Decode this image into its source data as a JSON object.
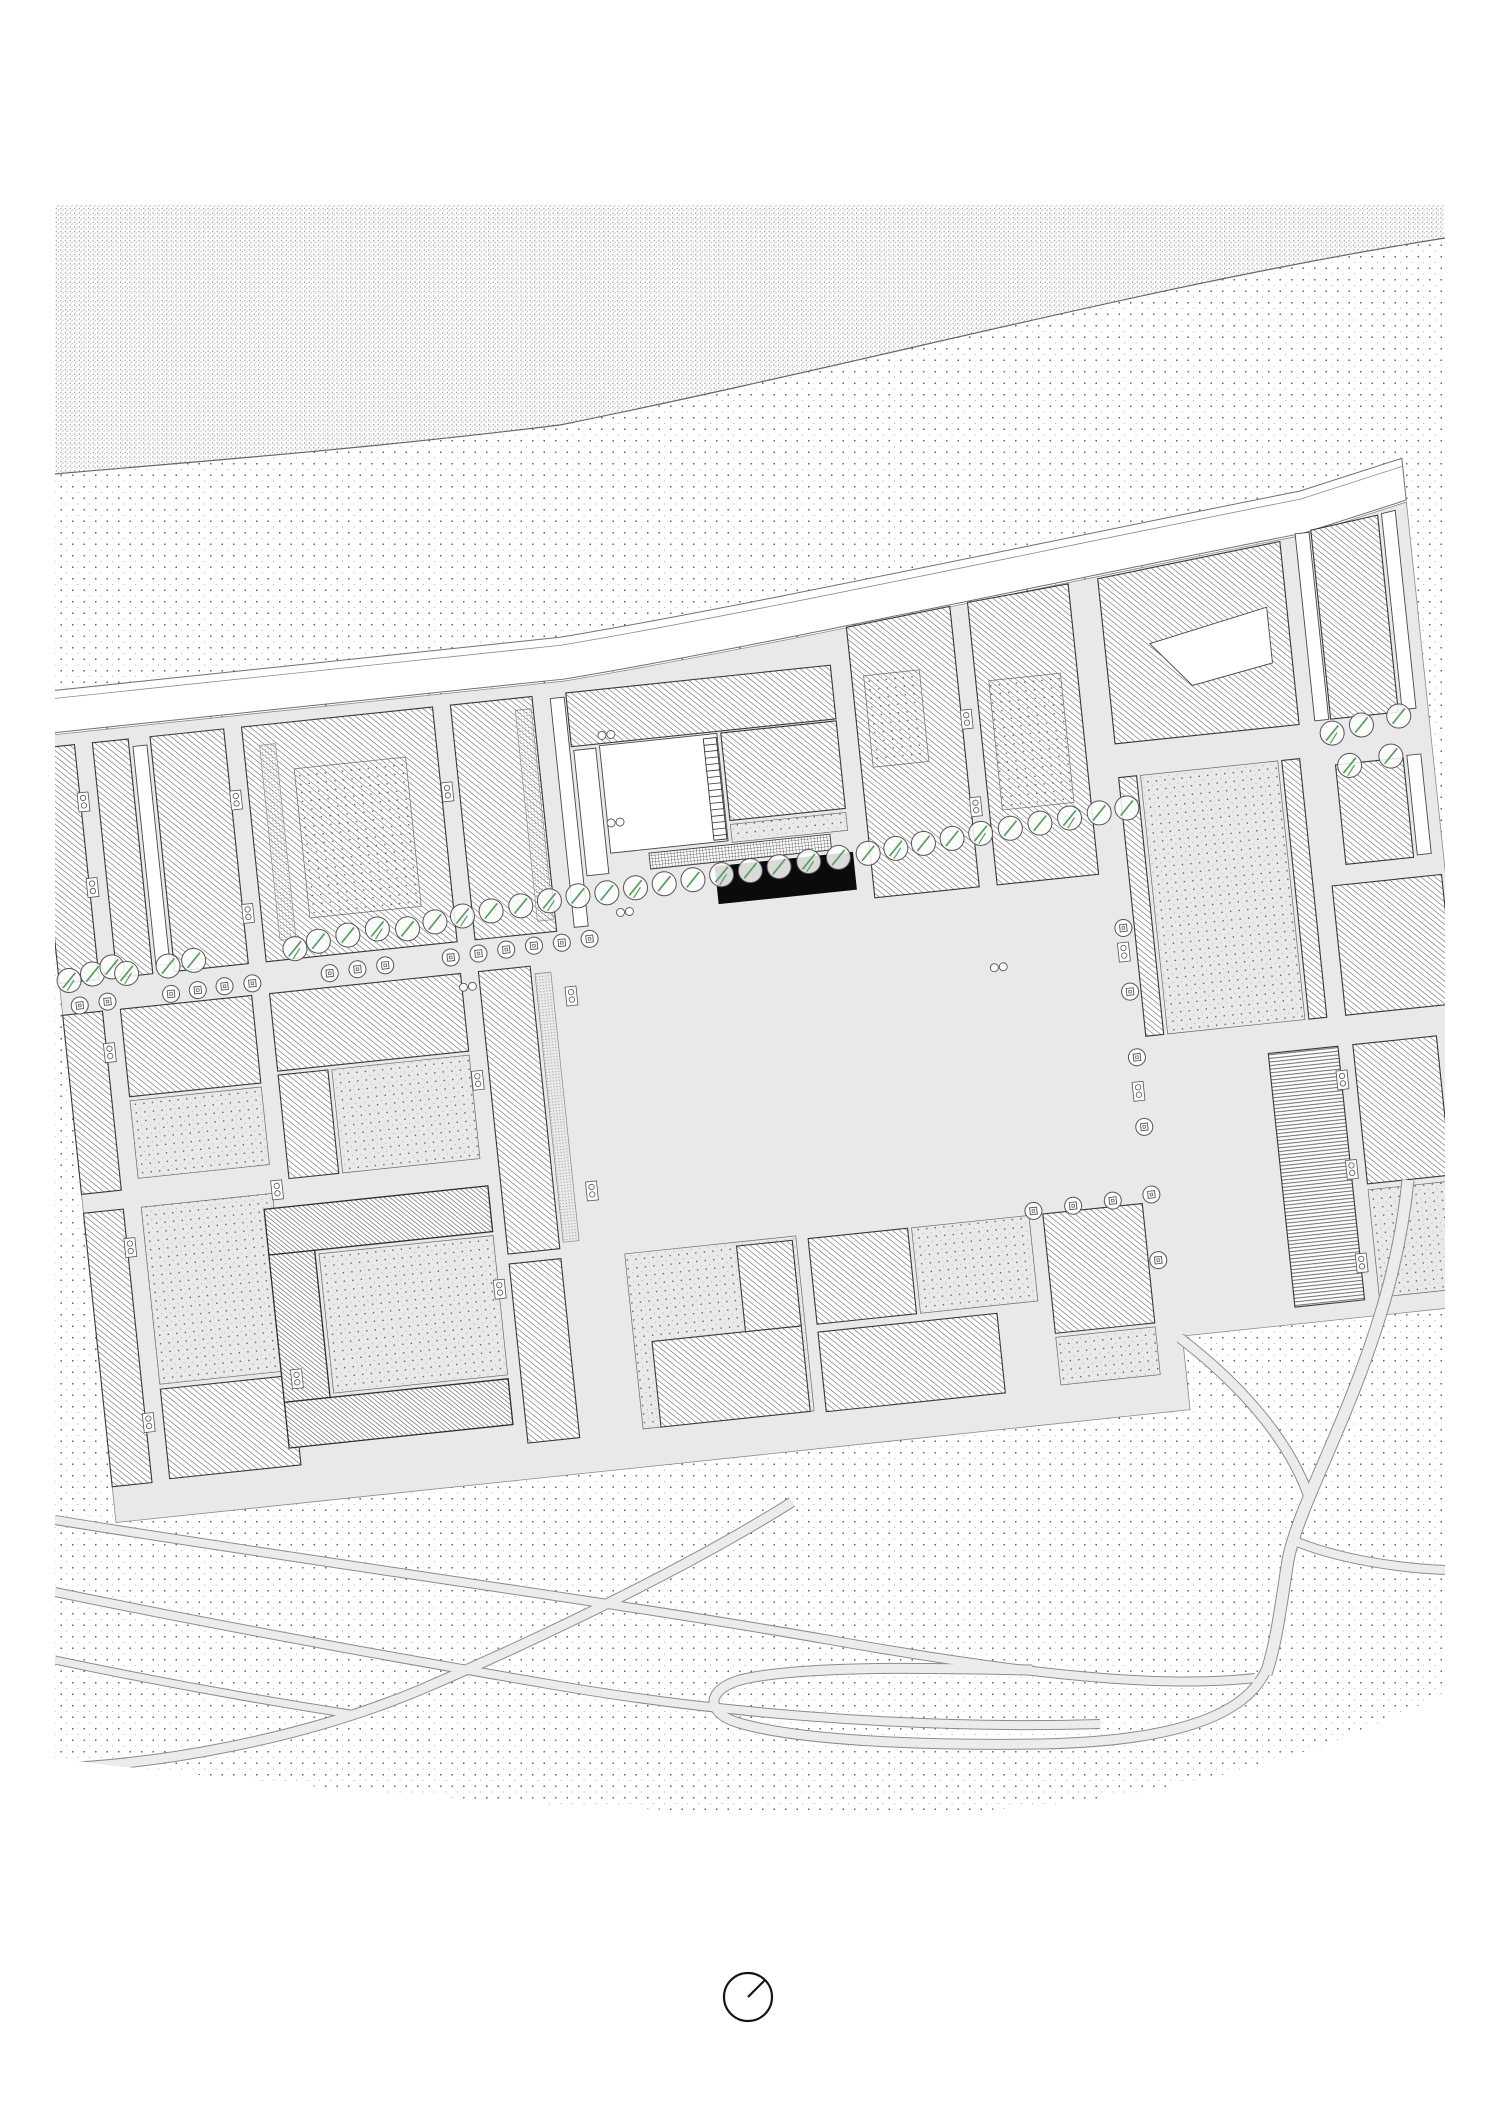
{
  "meta": {
    "width": 1500,
    "height": 2123,
    "background": "#ffffff",
    "kind": "architectural-site-plan"
  },
  "style": {
    "ink": "#3a3a3a",
    "building_outline": "#383838",
    "street_fill": "#e9e9e9",
    "street_edge": "#8c8c8c",
    "road_fill": "#ffffff",
    "road_edge": "#6f6f6f",
    "hatch_line": "#5c5c5c",
    "hatch_dense_line": "#474747",
    "grid_line": "#3c3c3c",
    "stipple_dark": "#636363",
    "stipple_light": "#aeaeae",
    "dense_a": "#8f8f8f",
    "dense_b": "#b5b5b5",
    "court_dark": "#4f4f4f",
    "court_light": "#9b9b9b",
    "fine_dot": "#7d7d7d",
    "tree_stroke": "#555555",
    "tree_green": "#55a05a",
    "black_building": "#0b0b0b",
    "north_stroke": "#151515"
  },
  "ground": {
    "dense_path": "M55,205 L1445,205 L1445,238 C1150,285 880,360 560,425 C340,452 140,466 55,474 Z",
    "sparse_path": "M55,474 C140,466 340,452 560,425 C880,360 1150,285 1445,238 L1445,1692 C1300,1770 1100,1815 850,1815 C600,1812 300,1790 55,1758 Z",
    "shore_path": "M55,474 C140,466 340,452 560,425 C880,360 1150,285 1445,238"
  },
  "city": {
    "rotation": {
      "angle": -6,
      "cx": 55,
      "cy": 990
    },
    "footprint_path": "M60,736 L594,736 C790,724 1100,690 1345,668 L1450,646 L1450,1452 L1140,1452 L1140,1526 L60,1526 Z",
    "road_band_path": "M60,692 L594,692 C790,680 1100,646 1345,624 L1450,602 L1450,644 L1345,666 C1100,688 790,722 594,734 L60,734 Z",
    "sidewalk_path": "M60,700 L594,700 C790,688 1100,654 1345,632 L1450,610",
    "plaza": {
      "r": [
        594,
        988,
        520,
        322
      ]
    },
    "stair": {
      "x": 726,
      "y": 808,
      "w": 13,
      "h": 102,
      "step": 6.5
    },
    "blocks": [
      {
        "n": "slab-west-a",
        "r": [
          60,
          748,
          40,
          236
        ],
        "f": "hatch"
      },
      {
        "n": "slab-col1-a",
        "r": [
          118,
          748,
          36,
          236
        ],
        "f": "hatch"
      },
      {
        "n": "strip-col1",
        "r": [
          158,
          756,
          14,
          220
        ],
        "f": "white"
      },
      {
        "n": "slab-col1-b",
        "r": [
          176,
          748,
          74,
          236
        ],
        "f": "hatch"
      },
      {
        "n": "block-col2-r1",
        "r": [
          268,
          748,
          192,
          236
        ],
        "f": "hatch"
      },
      {
        "n": "fine-col2-r1",
        "r": [
          284,
          768,
          16,
          196
        ],
        "f": "fine"
      },
      {
        "n": "court-col2-r1",
        "r": [
          316,
          795,
          112,
          150
        ],
        "f": "court"
      },
      {
        "n": "slab-col3-r1",
        "r": [
          478,
          748,
          82,
          236
        ],
        "f": "hatch"
      },
      {
        "n": "fine-col3-r1",
        "r": [
          542,
          760,
          16,
          212
        ],
        "f": "fine"
      },
      {
        "n": "strip-col3-r1",
        "r": [
          578,
          752,
          14,
          230
        ],
        "f": "white"
      },
      {
        "n": "site-north-bar",
        "r": [
          594,
          748,
          266,
          54
        ],
        "f": "hatch"
      },
      {
        "n": "site-west-slab",
        "r": [
          596,
          806,
          22,
          126
        ],
        "f": "white"
      },
      {
        "n": "site-courtyard",
        "r": [
          622,
          804,
          118,
          108
        ],
        "f": "white"
      },
      {
        "n": "site-east-arm",
        "r": [
          744,
          804,
          116,
          88
        ],
        "f": "hatch"
      },
      {
        "n": "site-east-yard",
        "r": [
          744,
          896,
          116,
          18
        ],
        "f": "court"
      },
      {
        "n": "site-grid-strip",
        "r": [
          660,
          916,
          182,
          16
        ],
        "f": "grid"
      },
      {
        "n": "highlighted-building",
        "r": [
          724,
          936,
          139,
          38
        ],
        "f": "black"
      },
      {
        "n": "block-r1-east1",
        "p": [
          [
            880,
            712
          ],
          [
            985,
            702
          ],
          [
            985,
            984
          ],
          [
            880,
            984
          ]
        ],
        "f": "hatch"
      },
      {
        "n": "court-r1-east1",
        "r": [
          892,
          762,
          56,
          92
        ],
        "f": "court"
      },
      {
        "n": "block-r1-east2",
        "p": [
          [
            1003,
            700
          ],
          [
            1105,
            692
          ],
          [
            1105,
            984
          ],
          [
            1003,
            984
          ]
        ],
        "f": "hatch"
      },
      {
        "n": "court-r1-east2",
        "r": [
          1016,
          780,
          72,
          130
        ],
        "f": "court"
      },
      {
        "n": "block-ne-large",
        "p": [
          [
            1135,
            690
          ],
          [
            1320,
            672
          ],
          [
            1320,
            856
          ],
          [
            1135,
            856
          ]
        ],
        "f": "hatch"
      },
      {
        "n": "notch-ne",
        "p": [
          [
            1180,
            760
          ],
          [
            1300,
            736
          ],
          [
            1300,
            792
          ],
          [
            1218,
            806
          ]
        ],
        "f": "white"
      },
      {
        "n": "strip-ne-a",
        "r": [
          1336,
          666,
          14,
          188
        ],
        "f": "white"
      },
      {
        "n": "slab-ne-a",
        "p": [
          [
            1352,
            664
          ],
          [
            1420,
            656
          ],
          [
            1420,
            854
          ],
          [
            1352,
            854
          ]
        ],
        "f": "hatch"
      },
      {
        "n": "strip-ne-b",
        "p": [
          [
            1424,
            655
          ],
          [
            1438,
            653
          ],
          [
            1438,
            852
          ],
          [
            1424,
            852
          ]
        ],
        "f": "white"
      },
      {
        "n": "slab-ne-b",
        "r": [
          1352,
          900,
          68,
          100
        ],
        "f": "hatch"
      },
      {
        "n": "strip-ne-c",
        "r": [
          1424,
          898,
          14,
          100
        ],
        "f": "white"
      },
      {
        "n": "slab-west-b",
        "r": [
          60,
          1016,
          40,
          180
        ],
        "f": "hatch"
      },
      {
        "n": "block-col1-r2",
        "r": [
          118,
          1016,
          132,
          88
        ],
        "f": "hatch"
      },
      {
        "n": "yard-col1-r2",
        "r": [
          118,
          1108,
          132,
          78
        ],
        "f": "court"
      },
      {
        "n": "bar-col2-r2",
        "r": [
          268,
          1016,
          192,
          78
        ],
        "f": "hatch"
      },
      {
        "n": "arm-col2-r2",
        "r": [
          268,
          1098,
          50,
          104
        ],
        "f": "hatch"
      },
      {
        "n": "court-col2-r2",
        "r": [
          322,
          1098,
          138,
          104
        ],
        "f": "court"
      },
      {
        "n": "slab-col3-r2",
        "r": [
          478,
          1016,
          52,
          284
        ],
        "f": "hatch"
      },
      {
        "n": "fine-col3-r2",
        "r": [
          534,
          1024,
          16,
          270
        ],
        "f": "fine"
      },
      {
        "n": "strip-e-plaza-a",
        "r": [
          1135,
          890,
          18,
          260
        ],
        "f": "hatch"
      },
      {
        "n": "yard-e-plaza",
        "r": [
          1157,
          890,
          138,
          260
        ],
        "f": "court"
      },
      {
        "n": "strip-e-plaza-b",
        "r": [
          1299,
          890,
          18,
          260
        ],
        "f": "hatch"
      },
      {
        "n": "block-ne-r2",
        "r": [
          1336,
          1020,
          110,
          130
        ],
        "f": "hatch"
      },
      {
        "n": "slab-west-c",
        "r": [
          60,
          1215,
          40,
          275
        ],
        "f": "hatch"
      },
      {
        "n": "yard-col1-r3",
        "r": [
          118,
          1215,
          132,
          178
        ],
        "f": "court"
      },
      {
        "n": "slab-col1-r3",
        "r": [
          118,
          1398,
          132,
          90
        ],
        "f": "hatch"
      },
      {
        "n": "cblock-top",
        "r": [
          240,
          1230,
          225,
          46
        ],
        "f": "hatchD"
      },
      {
        "n": "cblock-left",
        "r": [
          240,
          1276,
          46,
          148
        ],
        "f": "hatchD"
      },
      {
        "n": "cblock-bottom",
        "r": [
          240,
          1424,
          225,
          46
        ],
        "f": "hatchD"
      },
      {
        "n": "cblock-court",
        "r": [
          290,
          1280,
          175,
          140
        ],
        "f": "court"
      },
      {
        "n": "slab-col3-r3",
        "r": [
          478,
          1310,
          52,
          180
        ],
        "f": "hatch"
      },
      {
        "n": "yard-center-r3",
        "r": [
          594,
          1312,
          172,
          176
        ],
        "f": "court"
      },
      {
        "n": "slab-center-r3a",
        "r": [
          612,
          1402,
          150,
          86
        ],
        "f": "hatch"
      },
      {
        "n": "slab-center-r3b",
        "r": [
          706,
          1316,
          56,
          86
        ],
        "f": "hatch"
      },
      {
        "n": "slab-center-r3c",
        "r": [
          778,
          1316,
          100,
          86
        ],
        "f": "hatch"
      },
      {
        "n": "yard-center-r3b",
        "r": [
          882,
          1316,
          118,
          86
        ],
        "f": "court"
      },
      {
        "n": "slab-center-r3d",
        "r": [
          778,
          1410,
          180,
          80
        ],
        "f": "hatch"
      },
      {
        "n": "block-se-r3",
        "r": [
          1014,
          1316,
          100,
          120
        ],
        "f": "hatch"
      },
      {
        "n": "yard-se-r3",
        "r": [
          1014,
          1440,
          100,
          48
        ],
        "f": "court"
      },
      {
        "n": "slab-horiz-hatch",
        "r": [
          1255,
          1180,
          70,
          255
        ],
        "f": "hatchH"
      },
      {
        "n": "block-far-se",
        "r": [
          1340,
          1180,
          84,
          140
        ],
        "f": "hatch"
      },
      {
        "n": "yard-far-se",
        "r": [
          1340,
          1326,
          84,
          108
        ],
        "f": "court"
      }
    ],
    "markers": [
      [
        103,
        806
      ],
      [
        103,
        892
      ],
      [
        103,
        1058
      ],
      [
        103,
        1254
      ],
      [
        103,
        1430
      ],
      [
        255,
        820
      ],
      [
        255,
        934
      ],
      [
        255,
        1212
      ],
      [
        255,
        1402
      ],
      [
        466,
        834
      ],
      [
        466,
        1124
      ],
      [
        466,
        1334
      ],
      [
        568,
        1050
      ],
      [
        568,
        1246
      ],
      [
        990,
        816
      ],
      [
        990,
        904
      ],
      [
        1122,
        1064
      ],
      [
        1122,
        1204
      ],
      [
        1326,
        1214
      ],
      [
        1326,
        1304
      ],
      [
        1326,
        1398
      ]
    ],
    "pairs": [
      [
        630,
        794
      ],
      [
        630,
        882
      ],
      [
        630,
        972
      ],
      [
        996,
        1066
      ],
      [
        466,
        1030
      ]
    ],
    "trees": {
      "slash": [
        [
          70,
          982
        ],
        [
          94,
          978
        ],
        [
          114,
          973
        ],
        [
          128,
          981
        ],
        [
          170,
          978
        ],
        [
          196,
          975
        ],
        [
          298,
          974
        ],
        [
          322,
          969
        ],
        [
          352,
          966
        ],
        [
          382,
          963
        ],
        [
          412,
          966
        ],
        [
          440,
          962
        ],
        [
          468,
          959
        ],
        [
          497,
          957
        ],
        [
          527,
          955
        ],
        [
          556,
          953
        ],
        [
          585,
          951
        ],
        [
          614,
          951
        ],
        [
          643,
          949
        ],
        [
          672,
          948
        ],
        [
          701,
          947
        ],
        [
          730,
          945
        ],
        [
          759,
          944
        ],
        [
          788,
          943
        ],
        [
          818,
          941
        ],
        [
          848,
          940
        ],
        [
          878,
          939
        ],
        [
          906,
          937
        ],
        [
          934,
          935
        ],
        [
          963,
          933
        ],
        [
          992,
          931
        ],
        [
          1022,
          929
        ],
        [
          1052,
          927
        ],
        [
          1082,
          925
        ],
        [
          1112,
          923
        ],
        [
          1140,
          921
        ],
        [
          1352,
          868
        ],
        [
          1382,
          863
        ],
        [
          1420,
          858
        ],
        [
          1366,
          902
        ],
        [
          1408,
          897
        ]
      ],
      "square": [
        [
          78,
          1008
        ],
        [
          106,
          1007
        ],
        [
          170,
          1006
        ],
        [
          197,
          1005
        ],
        [
          224,
          1004
        ],
        [
          252,
          1004
        ],
        [
          330,
          1002
        ],
        [
          358,
          1001
        ],
        [
          386,
          1000
        ],
        [
          452,
          999
        ],
        [
          480,
          998
        ],
        [
          508,
          997
        ],
        [
          536,
          996
        ],
        [
          564,
          996
        ],
        [
          592,
          995
        ],
        [
          1124,
          1040
        ],
        [
          1124,
          1104
        ],
        [
          1124,
          1170
        ],
        [
          1124,
          1240
        ],
        [
          1124,
          1308
        ],
        [
          1124,
          1374
        ],
        [
          1005,
          1312
        ],
        [
          1045,
          1311
        ],
        [
          1085,
          1310
        ]
      ]
    }
  },
  "park": {
    "paths": [
      {
        "n": "park-path-1",
        "d": "M55,1520 C300,1560 600,1600 830,1640 C1000,1670 1150,1690 1255,1678",
        "w": 8
      },
      {
        "n": "park-path-2",
        "d": "M55,1592 C250,1632 420,1662 560,1686 C700,1710 900,1730 1100,1724",
        "w": 8
      },
      {
        "n": "park-path-3",
        "d": "M792,1502 C700,1560 560,1630 420,1690 C300,1740 160,1764 58,1768",
        "w": 9
      },
      {
        "n": "park-path-4",
        "d": "M55,1660 C150,1680 260,1700 350,1714",
        "w": 7
      },
      {
        "n": "park-connector",
        "d": "M1180,1338 C1240,1384 1290,1440 1310,1500",
        "w": 9
      },
      {
        "n": "road-east",
        "d": "M1408,1180 C1400,1260 1378,1330 1350,1400 C1322,1470 1296,1520 1288,1560 C1280,1612 1276,1644 1266,1674",
        "w": 11
      },
      {
        "n": "road-loop",
        "d": "M1266,1670 C1242,1724 1150,1742 1040,1744 C920,1746 792,1740 736,1722 C706,1712 706,1690 740,1680 C800,1665 930,1668 1032,1670",
        "w": 9
      },
      {
        "n": "road-branch",
        "d": "M1292,1540 C1340,1560 1400,1568 1445,1570",
        "w": 8
      }
    ]
  },
  "north_arrow": {
    "cx": 748,
    "cy": 1997,
    "r": 24,
    "needle_dx": 17,
    "needle_dy": -17
  }
}
